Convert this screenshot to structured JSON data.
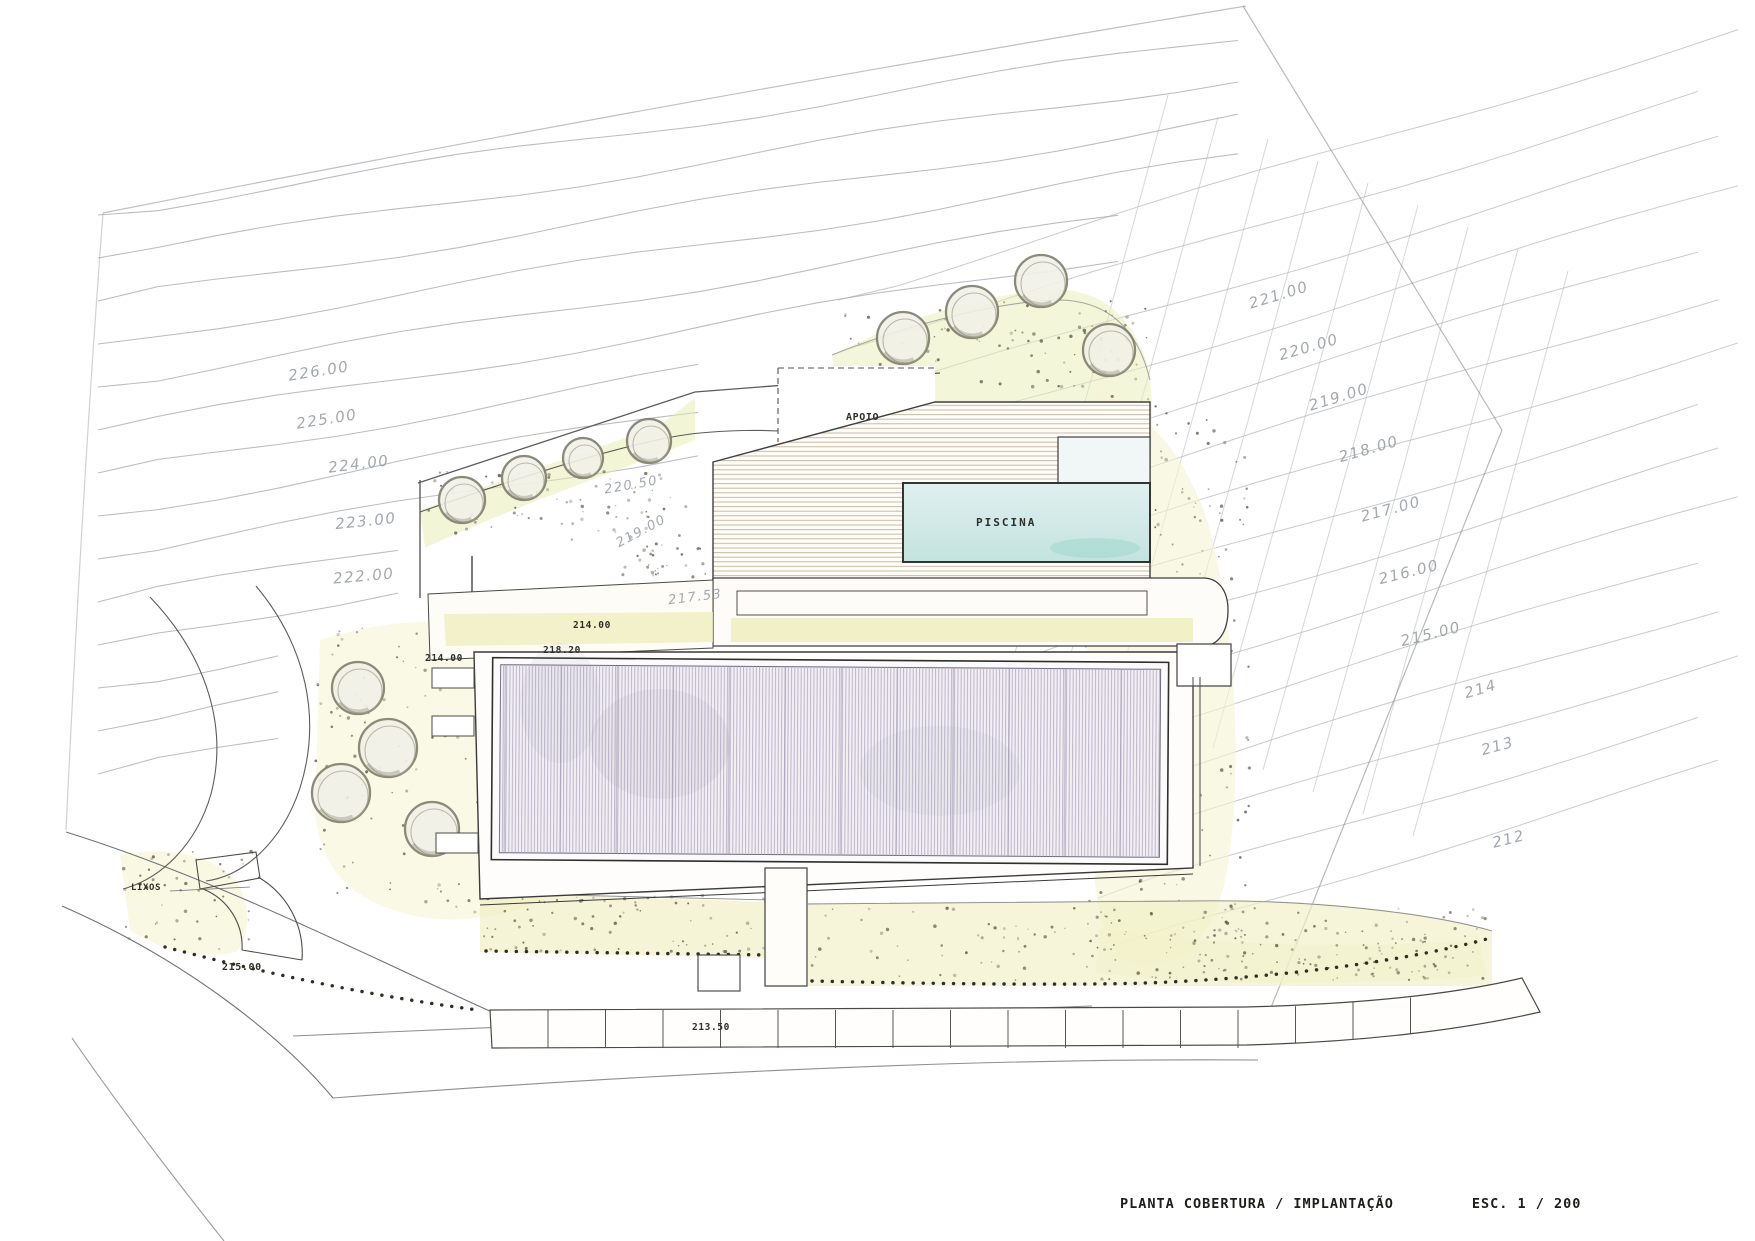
{
  "drawing": {
    "title": "PLANTA COBERTURA / IMPLANTAÇÃO",
    "scale": "ESC. 1 / 200"
  },
  "areas": {
    "apoio": "APOIO",
    "piscina": "PISCINA",
    "lixos": "LIXOS"
  },
  "contour_labels_left": [
    "226.00",
    "225.00",
    "224.00",
    "223.00",
    "222.00"
  ],
  "contour_labels_right": [
    "221.00",
    "220.00",
    "219.00",
    "218.00",
    "217.00",
    "216.00",
    "215.00",
    "214",
    "213",
    "212"
  ],
  "spot_elevations": {
    "upper_path": "220.50",
    "upper_path_2": "219.00",
    "courtyard": "217.53",
    "terrace_north": "214.00",
    "roof_level": "218.20",
    "terrace_west": "214.00",
    "street": "215.00",
    "parking": "213.50"
  },
  "palette": {
    "water": "#cfe8e6",
    "vegetation_wash": "#efedbd",
    "deck_lines": "#c9b9a4",
    "roof_hatch": "#b5adc2"
  }
}
